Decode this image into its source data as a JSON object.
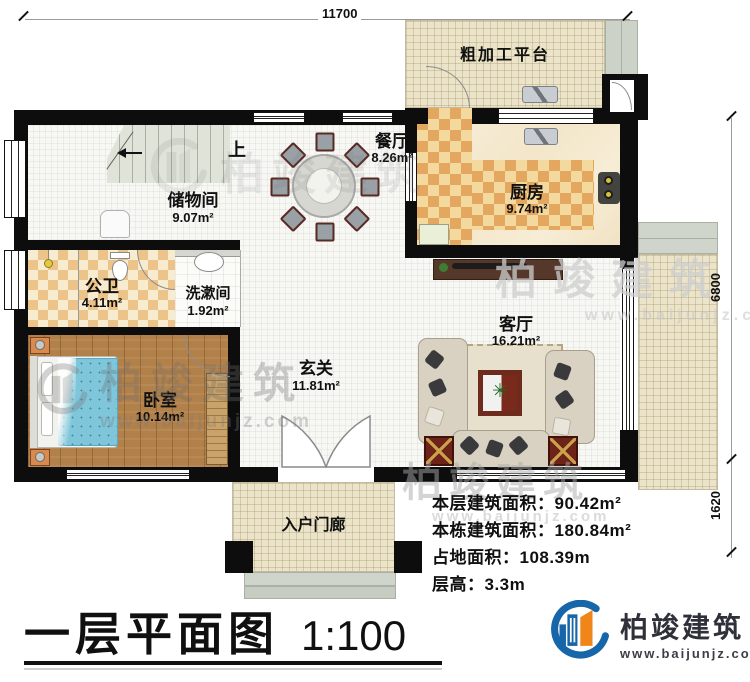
{
  "dimensions": {
    "top": "11700",
    "right_upper": "6800",
    "right_lower": "1620"
  },
  "stair": {
    "up_label": "上"
  },
  "rooms": {
    "platform": {
      "label": "粗加工平台"
    },
    "storage": {
      "label": "储物间",
      "area": "9.07m²"
    },
    "dining": {
      "label": "餐厅",
      "area": "8.26m²"
    },
    "kitchen": {
      "label": "厨房",
      "area": "9.74m²"
    },
    "bathroom": {
      "label": "公卫",
      "area": "4.11m²"
    },
    "washroom": {
      "label": "洗漱间",
      "area": "1.92m²"
    },
    "hall": {
      "label": "玄关",
      "area": "11.81m²"
    },
    "living": {
      "label": "客厅",
      "area": "16.21m²"
    },
    "bedroom": {
      "label": "卧室",
      "area": "10.14m²"
    },
    "porch": {
      "label": "入户门廊"
    }
  },
  "stats": {
    "floor_area": {
      "label": "本层建筑面积：",
      "value": "90.42m²"
    },
    "building_area": {
      "label": "本栋建筑面积：",
      "value": "180.84m²"
    },
    "land_area": {
      "label": "占地面积：",
      "value": "108.39m"
    },
    "floor_height": {
      "label": "层高：",
      "value": "3.3m"
    }
  },
  "title": {
    "name": "一层平面图",
    "scale": "1:100"
  },
  "brand": {
    "name": "柏竣建筑",
    "url": "www.baijunjz.com"
  },
  "watermark": {
    "name": "柏竣建筑",
    "url": "www.baijunjz.com"
  },
  "colors": {
    "wall": "#0d0d0d",
    "brand_blue": "#1766a9",
    "brand_orange": "#f08519",
    "kitchen_checker": "#e3a75f",
    "bath_checker": "#ecc489",
    "wood_floor": "#b28049",
    "plan_beige": "#ebe4ca"
  }
}
